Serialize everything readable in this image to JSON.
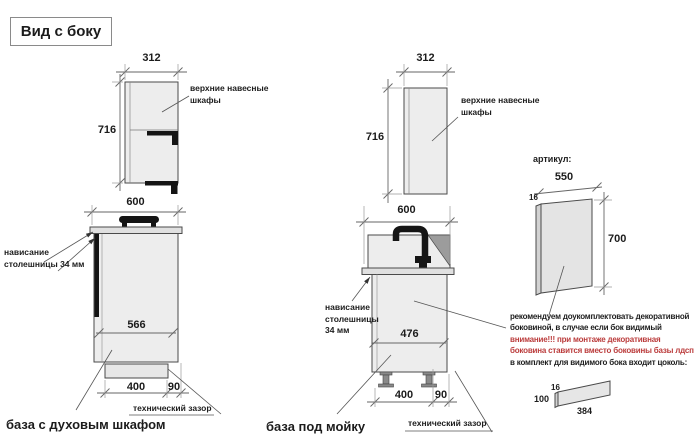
{
  "title": "Вид с боку",
  "wall_cabinet_left": {
    "width": "312",
    "height": "716",
    "label1": "верхние навесные",
    "label2": "шкафы"
  },
  "wall_cabinet_mid": {
    "width": "312",
    "height": "716",
    "label1": "верхние навесные",
    "label2": "шкафы"
  },
  "base_oven": {
    "width": "600",
    "overhang1": "нависание",
    "overhang2": "столешницы 34 мм",
    "depth": "566",
    "plinth": "400",
    "gap": "90",
    "gap_label": "технический зазор",
    "caption": "база с духовым шкафом"
  },
  "base_sink": {
    "width": "600",
    "overhang1": "нависание",
    "overhang2": "столешницы",
    "overhang3": "34 мм",
    "depth": "476",
    "plinth": "400",
    "gap": "90",
    "gap_label": "технический зазор",
    "caption": "база под мойку"
  },
  "side_panel": {
    "heading": "артикул:",
    "width": "550",
    "thickness": "16",
    "height": "700"
  },
  "note": {
    "line1": "рекомендуем доукомплектовать декоративной",
    "line2": "боковиной, в случае если бок видимый",
    "warn1": "внимание!!! при монтаже декоративная",
    "warn2": "боковина ставится вместо боковины базы лдсп",
    "line3": "в комплект для видимого бока входит цоколь:"
  },
  "plinth_part": {
    "thickness": "16",
    "height": "100",
    "length": "384"
  },
  "colors": {
    "warning_red": "#bb3c3c",
    "cabinet_fill": "#ededed",
    "drainboard_fill": "#9c9c9c",
    "line": "#4a4a4a"
  }
}
